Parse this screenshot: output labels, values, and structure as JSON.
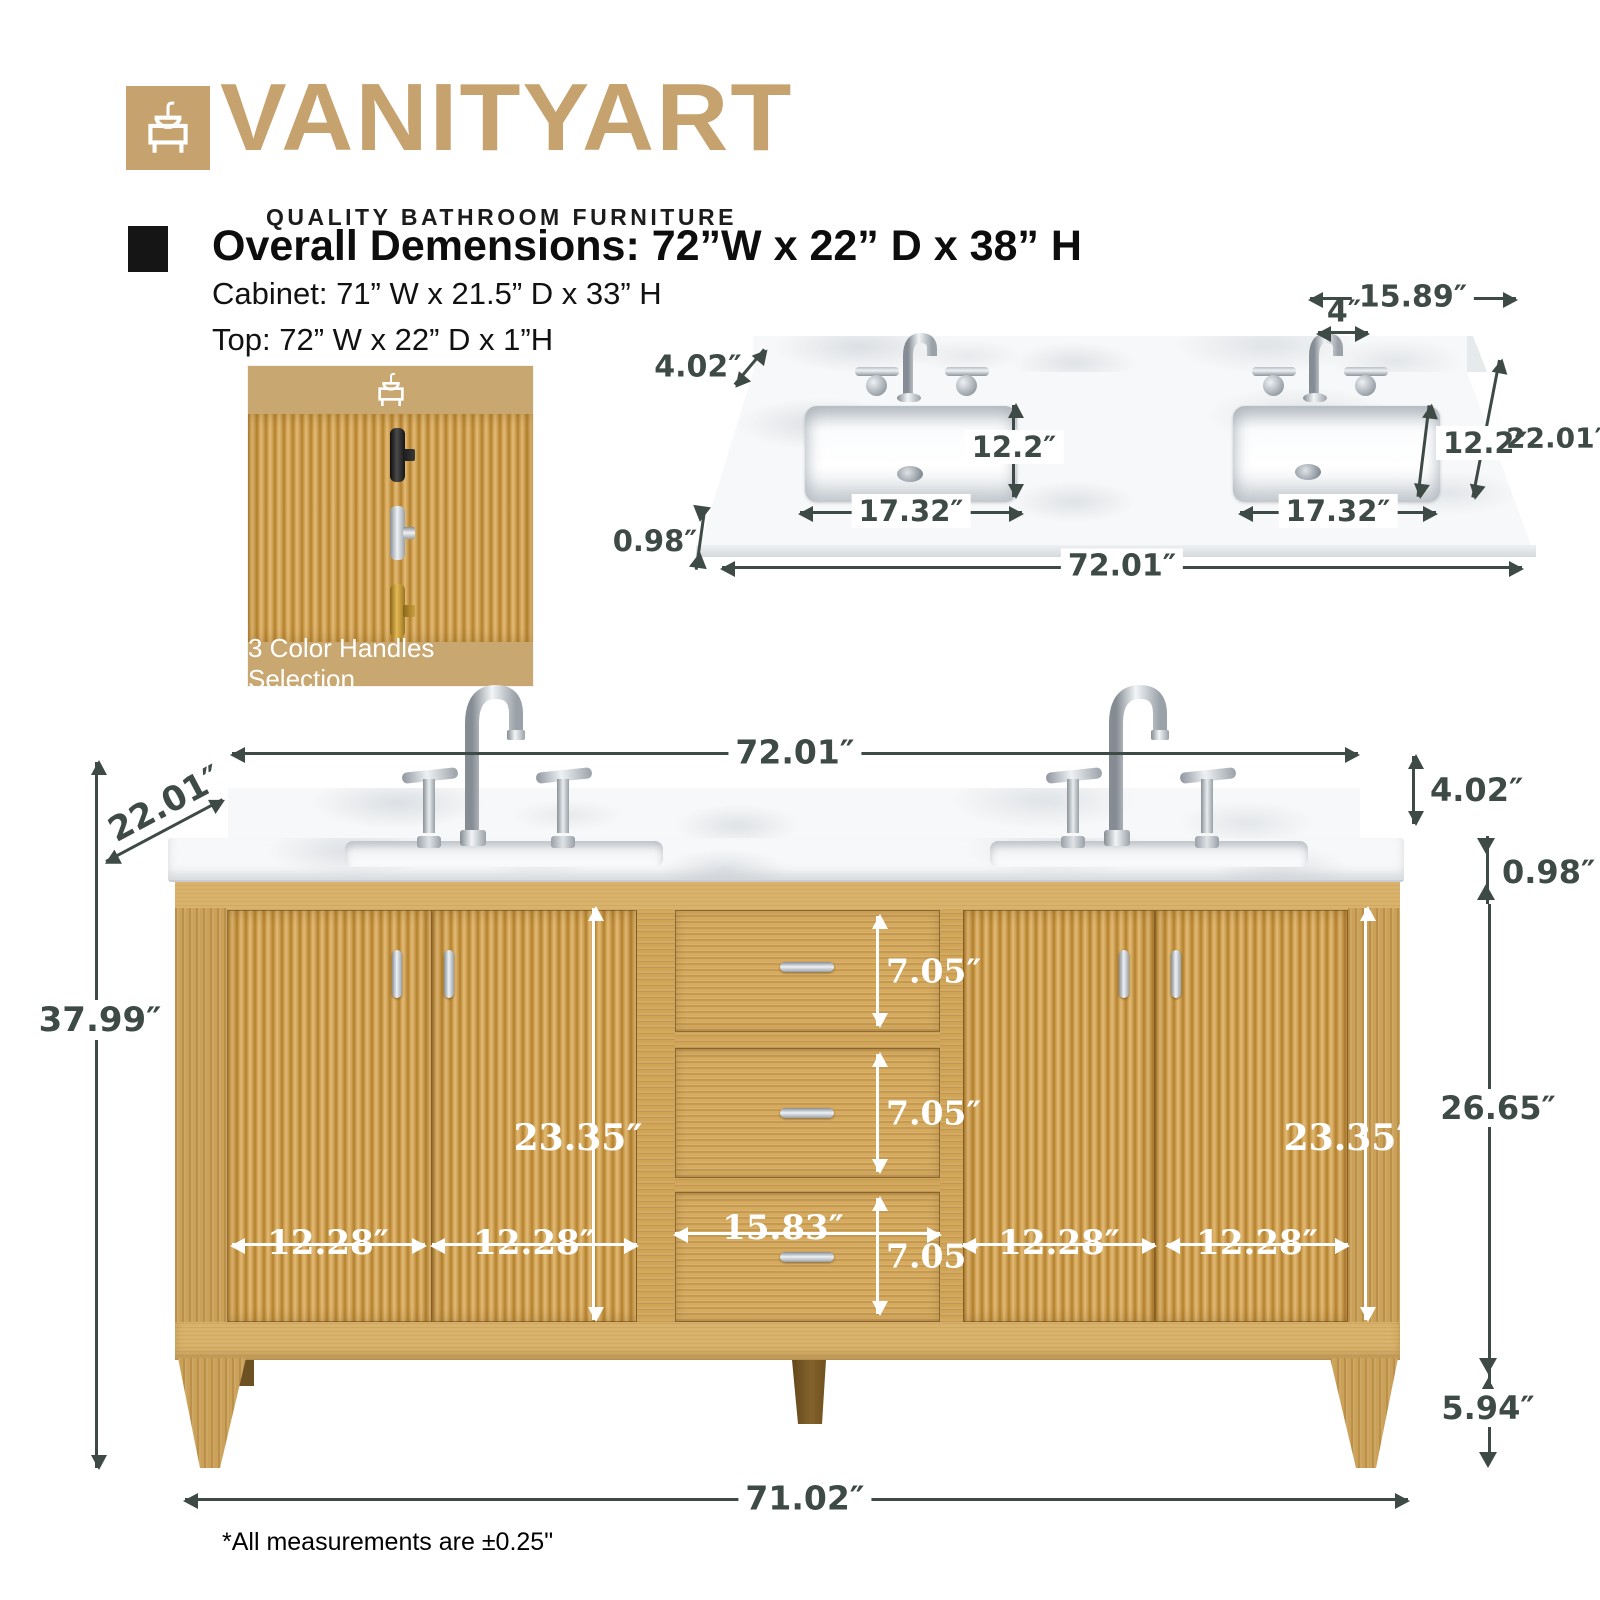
{
  "brand": {
    "name": "VANITYART",
    "tagline": "QUALITY BATHROOM FURNITURE"
  },
  "header": {
    "title": "Overall Demensions: 72”W x 22” D x 38” H",
    "cabinet_line": "Cabinet: 71” W x 21.5” D x 33” H",
    "top_line": "Top: 72” W x 22” D x 1”H"
  },
  "handles_swatch": {
    "caption": "3 Color Handles Selection",
    "options": [
      "black",
      "chrome",
      "gold"
    ]
  },
  "countertop_view": {
    "span_right": "15.89″",
    "faucet_spacing": "4″",
    "backsplash_height": "4.02″",
    "sink_depth": [
      "12.2″",
      "12.2″"
    ],
    "sink_width": [
      "17.32″",
      "17.32″"
    ],
    "depth": "22.01″",
    "thickness": "0.98″",
    "overall_width": "72.01″"
  },
  "front_view": {
    "overall_width": "72.01″",
    "depth": "22.01″",
    "overall_height": "37.99″",
    "backsplash_height": "4.02″",
    "counter_thickness": "0.98″",
    "door_heights": [
      "23.35″",
      "23.35″"
    ],
    "door_widths": [
      "12.28″",
      "12.28″",
      "12.28″",
      "12.28″"
    ],
    "drawer_heights": [
      "7.05″",
      "7.05″",
      "7.05″"
    ],
    "drawer_width": "15.83″",
    "cabinet_side_height": "26.65″",
    "leg_height": "5.94″",
    "base_width": "71.02″"
  },
  "footnote": "*All measurements are ±0.25\"",
  "colors": {
    "brand_tan": "#c6a26e",
    "swatch_tan": "#c9a771",
    "dimension_dark": "#3e4a45",
    "wood": "#cfa457",
    "annotation_white": "#ffffff"
  }
}
